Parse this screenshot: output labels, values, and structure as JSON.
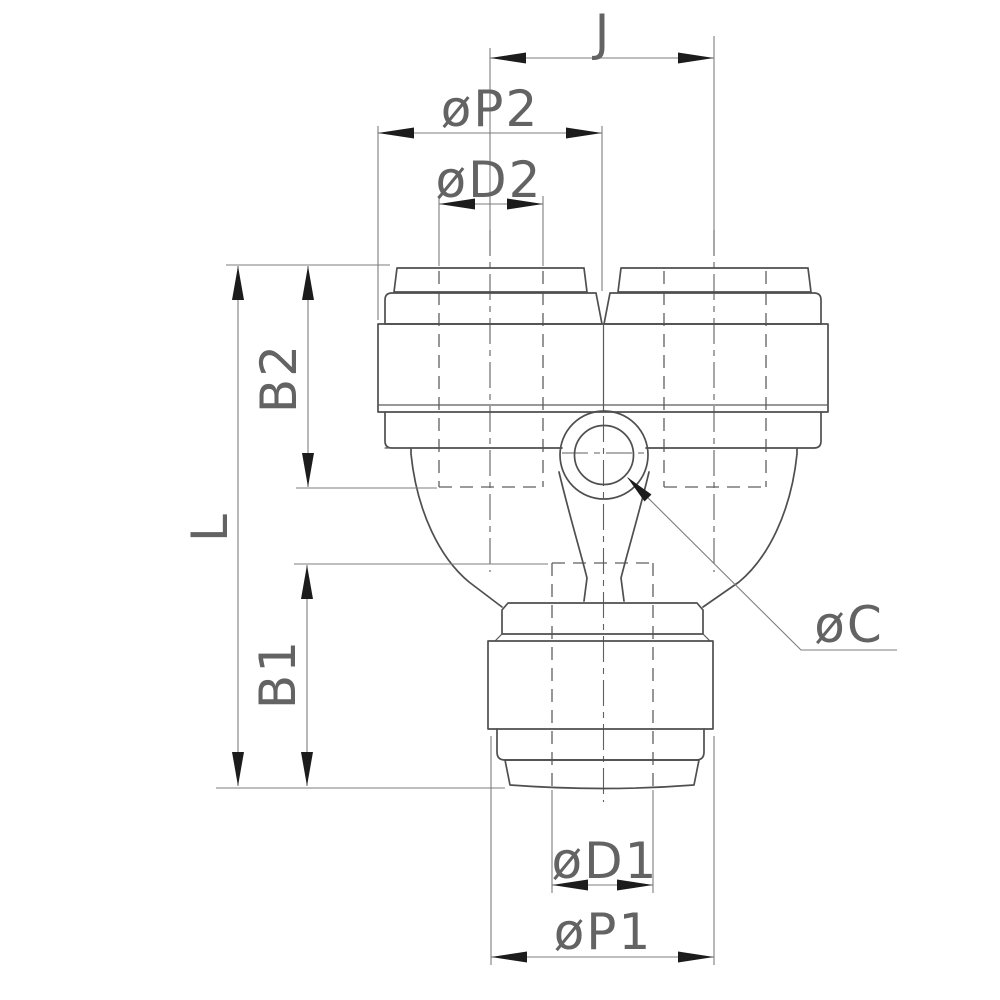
{
  "drawing": {
    "type": "technical-dimension-drawing",
    "subject": "union-y-push-to-connect-fitting-front-view",
    "colors": {
      "background": "#ffffff",
      "outline": "#4f4f4f",
      "dimension_lines": "#7d7d7d",
      "arrowheads": "#1c1c1c",
      "label_text": "#636363"
    },
    "dimensions": {
      "j": {
        "label": "J"
      },
      "p2": {
        "label": "øP2"
      },
      "d2": {
        "label": "øD2"
      },
      "b2": {
        "label": "B2"
      },
      "l": {
        "label": "L"
      },
      "b1": {
        "label": "B1"
      },
      "c": {
        "label": "øC"
      },
      "d1": {
        "label": "øD1"
      },
      "p1": {
        "label": "øP1"
      }
    }
  }
}
